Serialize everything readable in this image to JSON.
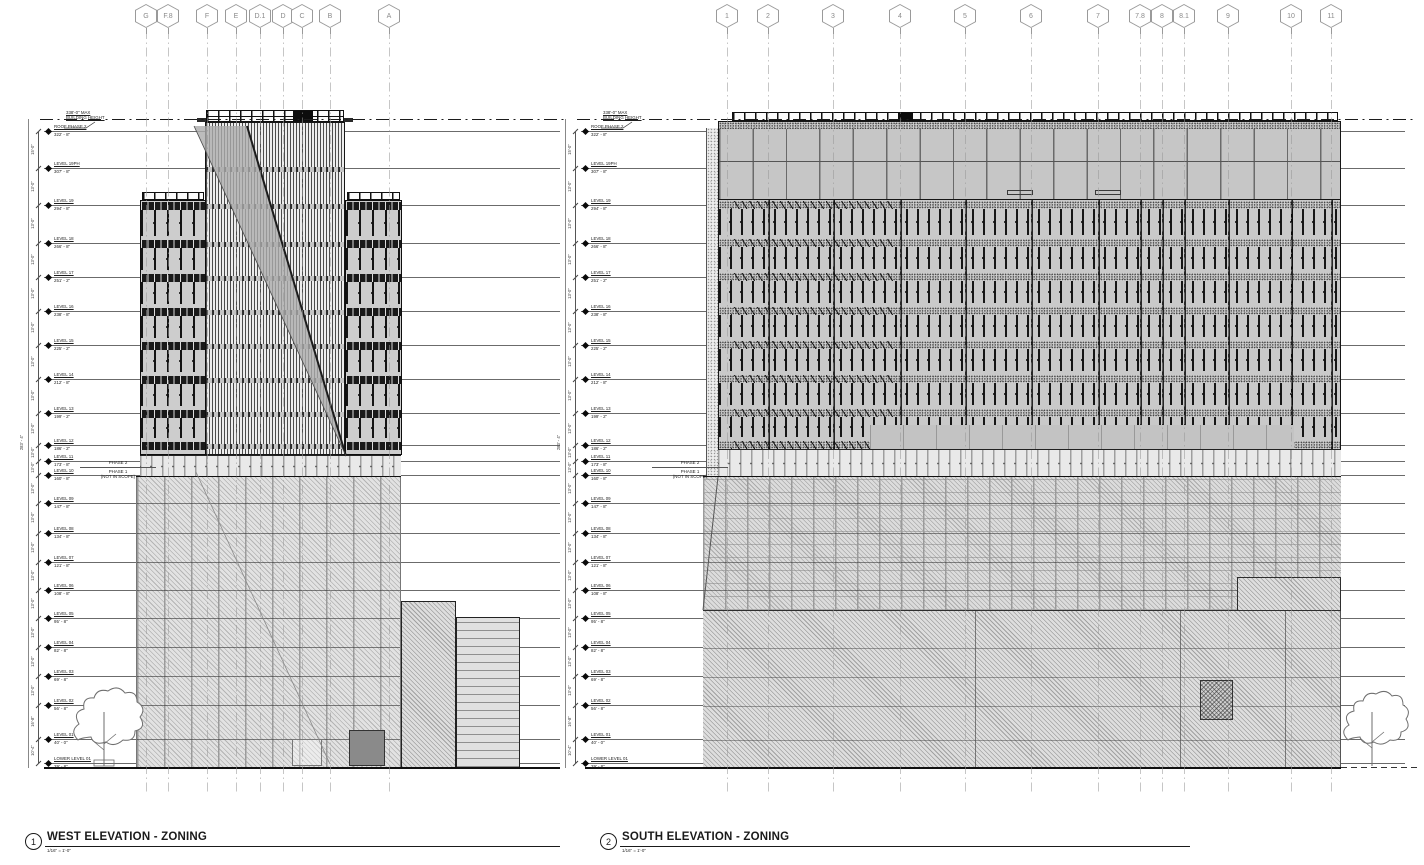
{
  "titles": {
    "west": {
      "number": "1",
      "title": "WEST ELEVATION - ZONING",
      "scale": "1/16\" = 1'-0\""
    },
    "south": {
      "number": "2",
      "title": "SOUTH ELEVATION - ZONING",
      "scale": "1/16\" = 1'-0\""
    }
  },
  "annotations": {
    "max_height_line1": "338'-0\" MAX",
    "max_height_line2": "BUILDING HEIGHT",
    "overall_dimension": "283' - 4\"",
    "phase2": "PHASE 2",
    "phase1": "PHASE 1",
    "not_in_scope": "(NOT IN SCOPE)"
  },
  "west_grid": [
    "G",
    "F.8",
    "F",
    "E",
    "D.1",
    "D",
    "C",
    "B",
    "A"
  ],
  "south_grid": [
    "1",
    "2",
    "3",
    "4",
    "5",
    "6",
    "7",
    "7.8",
    "8",
    "8.1",
    "9",
    "10",
    "11"
  ],
  "levels": [
    {
      "name": "ROOF PHASE 2",
      "elev": "322' - 8\"",
      "y": 131,
      "dim": ""
    },
    {
      "name": "LEVEL 19PH",
      "elev": "307' - 8\"",
      "y": 168,
      "dim": "15'-0\""
    },
    {
      "name": "LEVEL 19",
      "elev": "294' - 8\"",
      "y": 205,
      "dim": "13'-0\""
    },
    {
      "name": "LEVEL 18",
      "elev": "266' - 8\"",
      "y": 243,
      "dim": "13'-0\""
    },
    {
      "name": "LEVEL 17",
      "elev": "251' - 2\"",
      "y": 277,
      "dim": "13'-0\""
    },
    {
      "name": "LEVEL 16",
      "elev": "238' - 8\"",
      "y": 311,
      "dim": "13'-0\""
    },
    {
      "name": "LEVEL 15",
      "elev": "225' - 2\"",
      "y": 345,
      "dim": "13'-0\""
    },
    {
      "name": "LEVEL 14",
      "elev": "212' - 8\"",
      "y": 379,
      "dim": "13'-0\""
    },
    {
      "name": "LEVEL 13",
      "elev": "199' - 2\"",
      "y": 413,
      "dim": "13'-0\""
    },
    {
      "name": "LEVEL 12",
      "elev": "186' - 2\"",
      "y": 445,
      "dim": "13'-0\""
    },
    {
      "name": "LEVEL 11",
      "elev": "173' - 8\"",
      "y": 461,
      "dim": "13'-0\""
    },
    {
      "name": "LEVEL 10",
      "elev": "160' - 8\"",
      "y": 475,
      "dim": "13'-0\""
    },
    {
      "name": "LEVEL 09",
      "elev": "147' - 8\"",
      "y": 503,
      "dim": "13'-0\""
    },
    {
      "name": "LEVEL 08",
      "elev": "134' - 8\"",
      "y": 533,
      "dim": "13'-0\""
    },
    {
      "name": "LEVEL 07",
      "elev": "121' - 8\"",
      "y": 562,
      "dim": "13'-0\""
    },
    {
      "name": "LEVEL 06",
      "elev": "108' - 8\"",
      "y": 590,
      "dim": "13'-0\""
    },
    {
      "name": "LEVEL 05",
      "elev": "95' - 8\"",
      "y": 618,
      "dim": "13'-0\""
    },
    {
      "name": "LEVEL 04",
      "elev": "82' - 8\"",
      "y": 647,
      "dim": "13'-0\""
    },
    {
      "name": "LEVEL 03",
      "elev": "69' - 8\"",
      "y": 676,
      "dim": "13'-0\""
    },
    {
      "name": "LEVEL 02",
      "elev": "56' - 8\"",
      "y": 705,
      "dim": "13'-0\""
    },
    {
      "name": "LEVEL 01",
      "elev": "40' - 0\"",
      "y": 739,
      "dim": "16'-8\""
    },
    {
      "name": "LOWER LEVEL 01",
      "elev": "29' - 8\"",
      "y": 763,
      "dim": "10'-4\""
    }
  ]
}
